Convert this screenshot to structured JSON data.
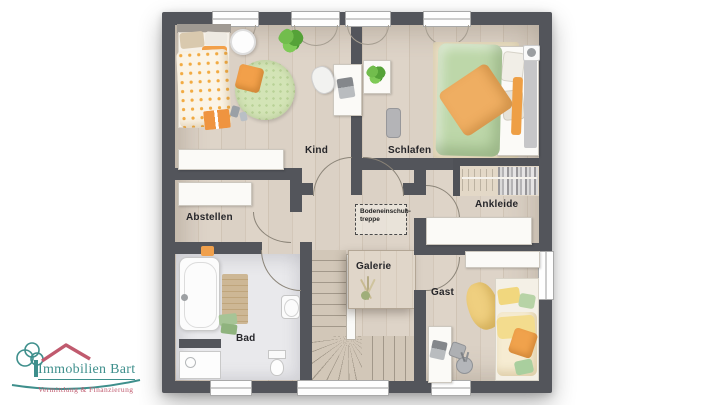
{
  "logo": {
    "title": "Immobilien Bart",
    "subtitle": "Vermittlung & Finanzierung",
    "teal": "#3E8F8C",
    "rose": "#C05A6E"
  },
  "floorplan": {
    "rooms": {
      "kind": "Kind",
      "schlafen": "Schlafen",
      "abstellen": "Abstellen",
      "ankleide": "Ankleide",
      "galerie": "Galerie",
      "gast": "Gast",
      "bad": "Bad"
    },
    "attic": {
      "line1": "Bodeneinschub-",
      "line2": "treppe"
    },
    "colors": {
      "wall": "#53555B",
      "wood_floor": "#D8CDC0",
      "bath_floor": "#E9E9EC",
      "accent_orange": "#F0A24C",
      "rug_green": "#CFE3B4",
      "bed_green": "#BDD7A9"
    }
  }
}
